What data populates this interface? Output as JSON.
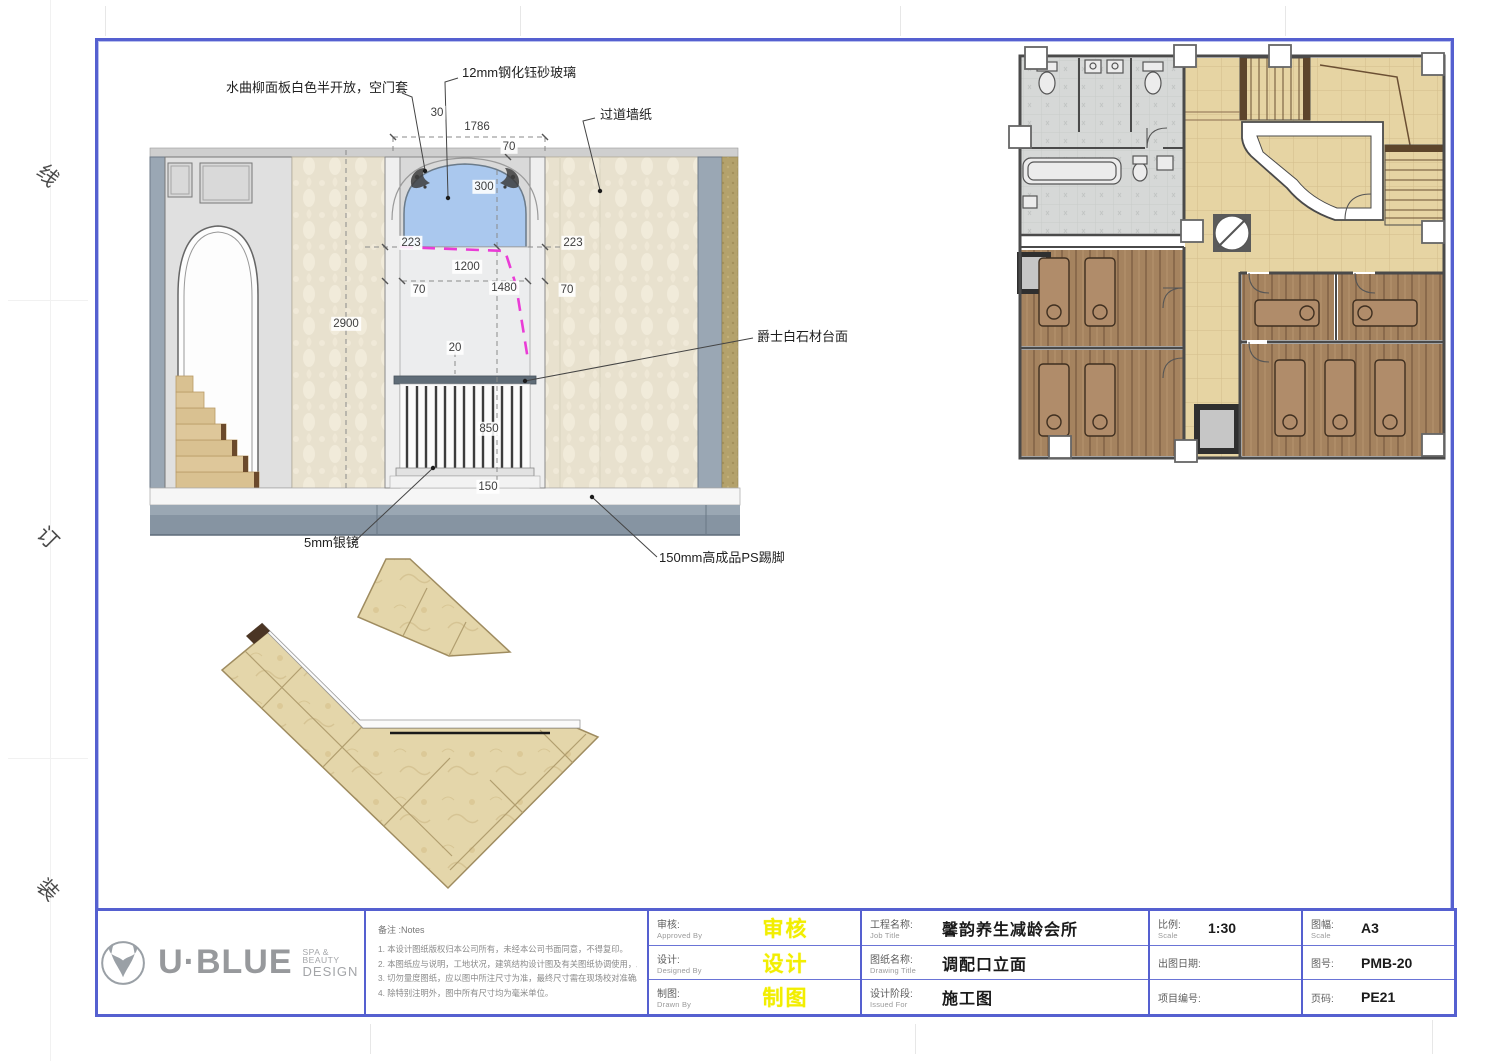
{
  "binding_marks": [
    "线",
    "订",
    "装"
  ],
  "colors": {
    "frame_blue": "#5560d0",
    "stamp_yellow": "#f2ee00",
    "glass_blue": "#aac8ee",
    "highlight_magenta": "#ea3cd6",
    "wallpaper_beige": "#e8e1ce",
    "wood_brown": "#a5835f",
    "corridor_tan": "#e6d4a3",
    "floor_gray": "#8694a2"
  },
  "elevation": {
    "annotations": {
      "panel": "水曲柳面板白色半开放，空门套",
      "glass": "12mm钢化钰砂玻璃",
      "wallpaper": "过道墙纸",
      "counter": "爵士白石材台面",
      "mirror": "5mm银镜",
      "skirting": "150mm高成品PS踢脚"
    },
    "dims": {
      "w30": "30",
      "w1786": "1786",
      "t70": "70",
      "r300": "300",
      "l223": "223",
      "r223": "223",
      "w1200": "1200",
      "j70l": "70",
      "w1480": "1480",
      "j70r": "70",
      "h2900": "2900",
      "g20": "20",
      "h850": "850",
      "h150": "150"
    }
  },
  "title_block": {
    "logo": {
      "brand": "U·BLUE",
      "tagline_line1": "SPA & BEAUTY",
      "tagline_line2": "DESIGN"
    },
    "notes": {
      "heading": "备注 :Notes",
      "lines": [
        "1. 本设计图纸版权归本公司所有，未经本公司书面同意，不得复印。",
        "2. 本图纸应与说明，工地状况，建筑结构设计图及有关图纸协调使用，发现任何差异请立即通知设计师。",
        "3. 切勿量度图纸，应以图中所注尺寸为准，最终尺寸需在现场校对准确。",
        "4. 除特别注明外，图中所有尺寸均为毫米单位。"
      ]
    },
    "personnel": [
      {
        "label_cn": "审核:",
        "label_en": "Approved By",
        "value": "审核"
      },
      {
        "label_cn": "设计:",
        "label_en": "Designed By",
        "value": "设计"
      },
      {
        "label_cn": "制图:",
        "label_en": "Drawn By",
        "value": "制图"
      }
    ],
    "drawing_info": [
      {
        "label_cn": "工程名称:",
        "label_en": "Job Title",
        "value": "馨韵养生减龄会所"
      },
      {
        "label_cn": "图纸名称:",
        "label_en": "Drawing Title",
        "value": "调配口立面"
      },
      {
        "label_cn": "设计阶段:",
        "label_en": "Issued For",
        "value": "施工图"
      }
    ],
    "meta_left": [
      {
        "label_cn": "比例:",
        "label_en": "Scale",
        "value": "1:30"
      },
      {
        "label_cn": "出图日期:",
        "label_en": "",
        "value": ""
      },
      {
        "label_cn": "项目编号:",
        "label_en": "",
        "value": ""
      }
    ],
    "meta_right": [
      {
        "label_cn": "图幅:",
        "label_en": "Scale",
        "value": "A3"
      },
      {
        "label_cn": "图号:",
        "label_en": "",
        "value": "PMB-20"
      },
      {
        "label_cn": "页码:",
        "label_en": "",
        "value": "PE21"
      }
    ]
  }
}
